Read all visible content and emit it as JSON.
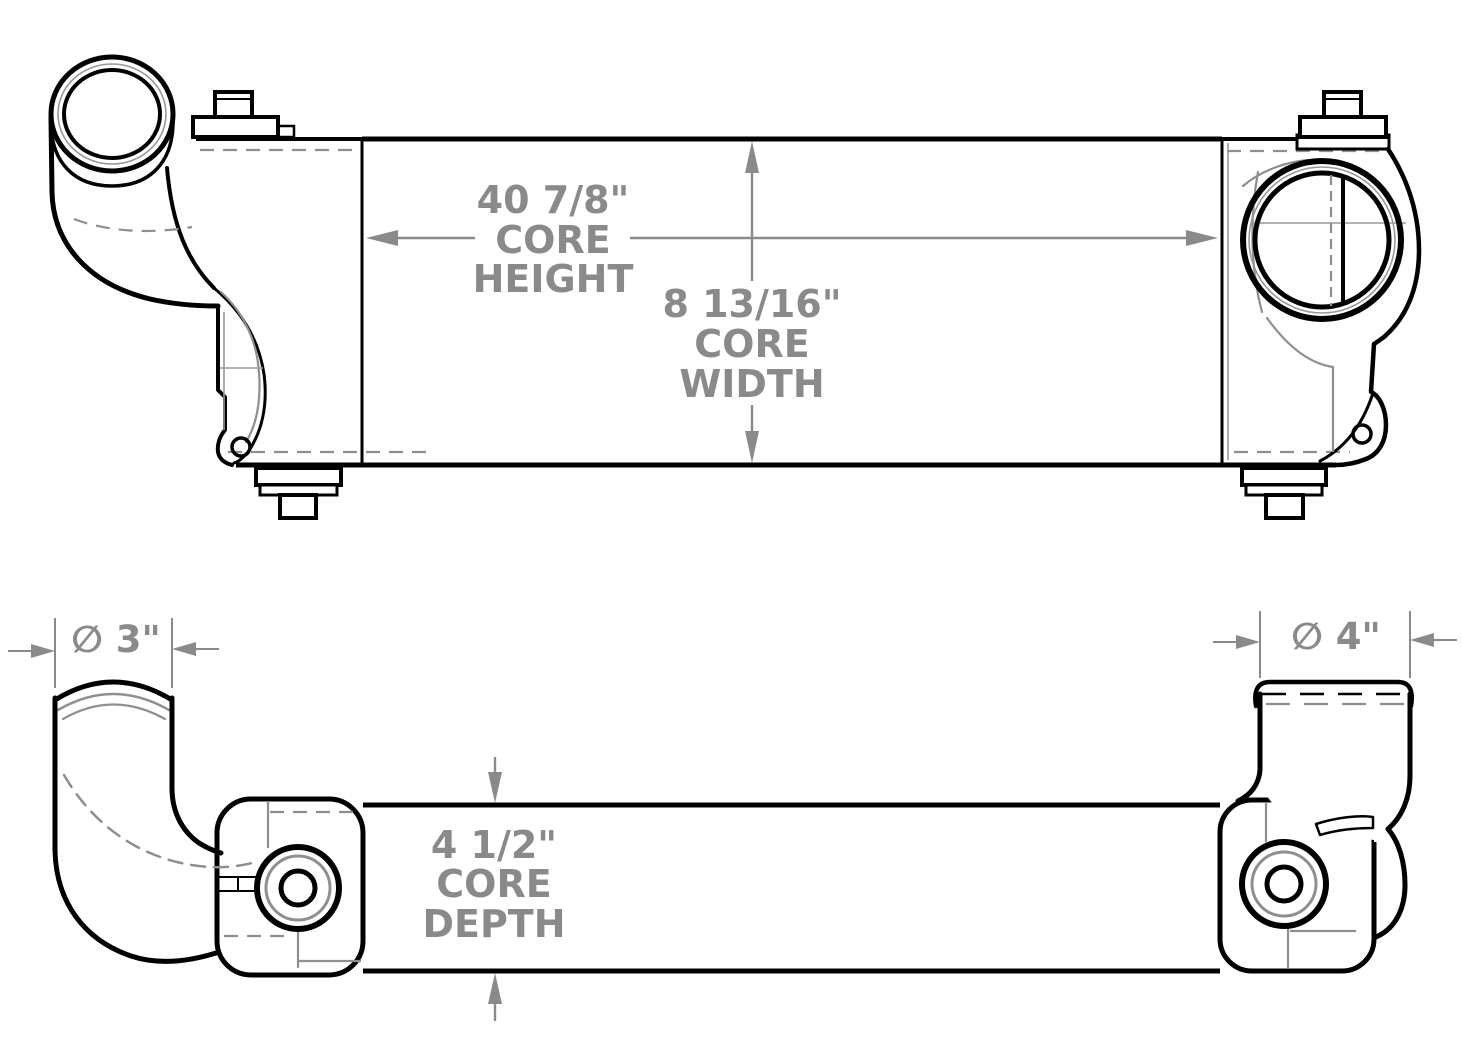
{
  "colors": {
    "background": "#ffffff",
    "outline": "#000000",
    "detail_gray": "#8f8f8f",
    "dimension_gray": "#8a8a8a"
  },
  "front_view": {
    "dimensions": {
      "core_height": {
        "line1": "40 7/8\"",
        "line2": "CORE",
        "line3": "HEIGHT"
      },
      "core_width": {
        "line1": "8 13/16\"",
        "line2": "CORE",
        "line3": "WIDTH"
      }
    }
  },
  "plan_view": {
    "dimensions": {
      "core_depth": {
        "line1": "4 1/2\"",
        "line2": "CORE",
        "line3": "DEPTH"
      },
      "inlet_pipe_diameter": {
        "label": "∅ 3\""
      },
      "outlet_pipe_diameter": {
        "label": "∅ 4\""
      }
    }
  }
}
